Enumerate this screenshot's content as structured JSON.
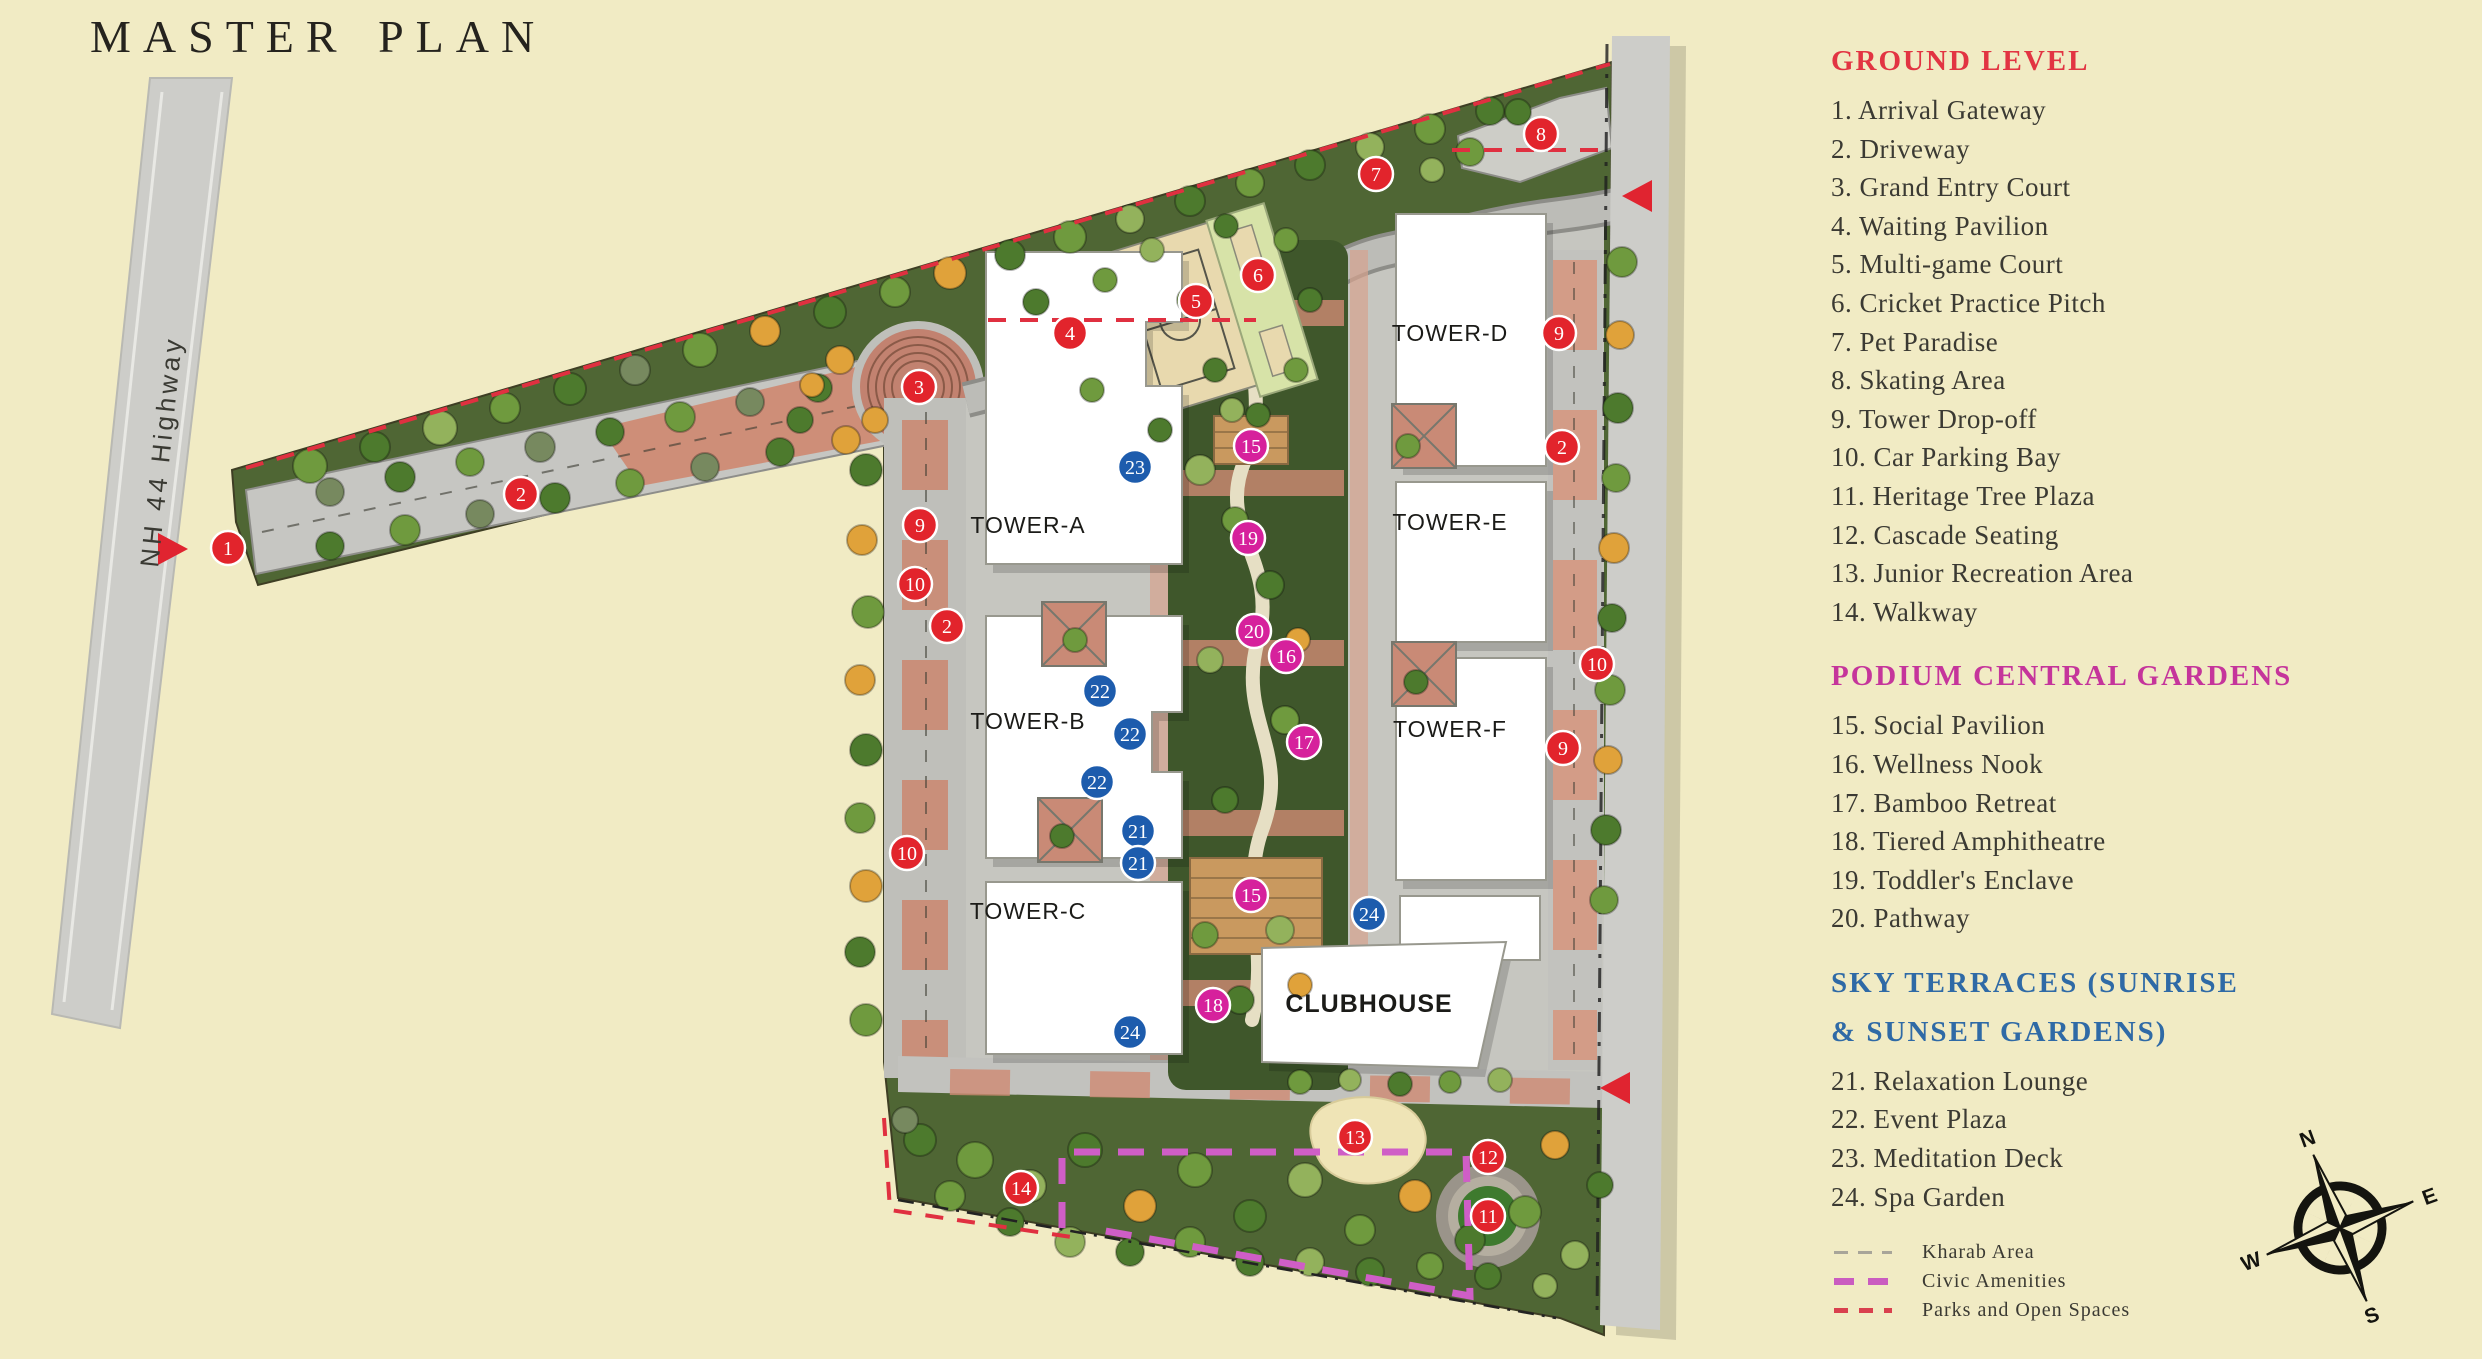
{
  "title": "MASTER PLAN",
  "legend": {
    "sections": [
      {
        "heading_lines": [
          "GROUND LEVEL"
        ],
        "color": "#e23442",
        "items": [
          {
            "n": "1",
            "label": "Arrival Gateway"
          },
          {
            "n": "2",
            "label": "Driveway"
          },
          {
            "n": "3",
            "label": "Grand Entry Court"
          },
          {
            "n": "4",
            "label": "Waiting Pavilion"
          },
          {
            "n": "5",
            "label": "Multi-game Court"
          },
          {
            "n": "6",
            "label": "Cricket Practice Pitch"
          },
          {
            "n": "7",
            "label": "Pet Paradise"
          },
          {
            "n": "8",
            "label": "Skating Area"
          },
          {
            "n": "9",
            "label": "Tower Drop-off"
          },
          {
            "n": "10",
            "label": "Car Parking Bay"
          },
          {
            "n": "11",
            "label": "Heritage Tree Plaza"
          },
          {
            "n": "12",
            "label": "Cascade Seating"
          },
          {
            "n": "13",
            "label": "Junior Recreation Area"
          },
          {
            "n": "14",
            "label": "Walkway"
          }
        ]
      },
      {
        "heading_lines": [
          "PODIUM CENTRAL GARDENS"
        ],
        "color": "#c5359b",
        "items": [
          {
            "n": "15",
            "label": "Social Pavilion"
          },
          {
            "n": "16",
            "label": "Wellness Nook"
          },
          {
            "n": "17",
            "label": "Bamboo Retreat"
          },
          {
            "n": "18",
            "label": "Tiered Amphitheatre"
          },
          {
            "n": "19",
            "label": "Toddler's Enclave"
          },
          {
            "n": "20",
            "label": "Pathway"
          }
        ]
      },
      {
        "heading_lines": [
          "SKY TERRACES (SUNRISE",
          "& SUNSET GARDENS)"
        ],
        "color": "#2f6aa6",
        "items": [
          {
            "n": "21",
            "label": "Relaxation Lounge"
          },
          {
            "n": "22",
            "label": "Event Plaza"
          },
          {
            "n": "23",
            "label": "Meditation Deck"
          },
          {
            "n": "24",
            "label": "Spa Garden"
          }
        ]
      }
    ],
    "line_items": [
      {
        "label": "Kharab Area",
        "color": "#a8a599",
        "thickness": 3,
        "dash": "14px",
        "gap": "10px"
      },
      {
        "label": "Civic Amenities",
        "color": "#ca5cc0",
        "thickness": 7,
        "dash": "20px",
        "gap": "14px"
      },
      {
        "label": "Parks and Open Spaces",
        "color": "#d9404e",
        "thickness": 5,
        "dash": "14px",
        "gap": "11px"
      }
    ]
  },
  "compass": {
    "n": "N",
    "e": "E",
    "s": "S",
    "w": "W"
  },
  "map": {
    "highway_label": "NH 44 Highway",
    "tower_labels": [
      {
        "text": "TOWER-A",
        "x": 1028,
        "y": 533,
        "size": 23,
        "bold": false
      },
      {
        "text": "TOWER-B",
        "x": 1028,
        "y": 729,
        "size": 23,
        "bold": false
      },
      {
        "text": "TOWER-C",
        "x": 1028,
        "y": 919,
        "size": 23,
        "bold": false
      },
      {
        "text": "TOWER-D",
        "x": 1450,
        "y": 341,
        "size": 23,
        "bold": false
      },
      {
        "text": "TOWER-E",
        "x": 1450,
        "y": 530,
        "size": 23,
        "bold": false
      },
      {
        "text": "TOWER-F",
        "x": 1450,
        "y": 737,
        "size": 23,
        "bold": false
      },
      {
        "text": "CLUBHOUSE",
        "x": 1369,
        "y": 1012,
        "size": 25,
        "bold": true
      }
    ],
    "marker_colors": {
      "ground": "#e2242c",
      "podium": "#d6219c",
      "sky": "#1d5cad"
    },
    "markers": [
      {
        "n": "1",
        "g": "ground",
        "x": 228,
        "y": 548
      },
      {
        "n": "2",
        "g": "ground",
        "x": 521,
        "y": 494
      },
      {
        "n": "3",
        "g": "ground",
        "x": 919,
        "y": 387
      },
      {
        "n": "4",
        "g": "ground",
        "x": 1070,
        "y": 333
      },
      {
        "n": "5",
        "g": "ground",
        "x": 1196,
        "y": 301
      },
      {
        "n": "6",
        "g": "ground",
        "x": 1258,
        "y": 275
      },
      {
        "n": "7",
        "g": "ground",
        "x": 1376,
        "y": 174
      },
      {
        "n": "8",
        "g": "ground",
        "x": 1541,
        "y": 134
      },
      {
        "n": "9",
        "g": "ground",
        "x": 1559,
        "y": 333
      },
      {
        "n": "2",
        "g": "ground",
        "x": 1562,
        "y": 447
      },
      {
        "n": "10",
        "g": "ground",
        "x": 1597,
        "y": 664
      },
      {
        "n": "9",
        "g": "ground",
        "x": 1563,
        "y": 748
      },
      {
        "n": "9",
        "g": "ground",
        "x": 920,
        "y": 525
      },
      {
        "n": "10",
        "g": "ground",
        "x": 915,
        "y": 584
      },
      {
        "n": "2",
        "g": "ground",
        "x": 947,
        "y": 626
      },
      {
        "n": "10",
        "g": "ground",
        "x": 907,
        "y": 853
      },
      {
        "n": "13",
        "g": "ground",
        "x": 1355,
        "y": 1137
      },
      {
        "n": "12",
        "g": "ground",
        "x": 1488,
        "y": 1157
      },
      {
        "n": "14",
        "g": "ground",
        "x": 1021,
        "y": 1188
      },
      {
        "n": "11",
        "g": "ground",
        "x": 1488,
        "y": 1216
      },
      {
        "n": "15",
        "g": "podium",
        "x": 1251,
        "y": 446
      },
      {
        "n": "19",
        "g": "podium",
        "x": 1248,
        "y": 538
      },
      {
        "n": "20",
        "g": "podium",
        "x": 1254,
        "y": 631
      },
      {
        "n": "16",
        "g": "podium",
        "x": 1286,
        "y": 656
      },
      {
        "n": "17",
        "g": "podium",
        "x": 1304,
        "y": 742
      },
      {
        "n": "15",
        "g": "podium",
        "x": 1251,
        "y": 895
      },
      {
        "n": "18",
        "g": "podium",
        "x": 1213,
        "y": 1005
      },
      {
        "n": "23",
        "g": "sky",
        "x": 1135,
        "y": 467
      },
      {
        "n": "22",
        "g": "sky",
        "x": 1100,
        "y": 691
      },
      {
        "n": "22",
        "g": "sky",
        "x": 1130,
        "y": 734
      },
      {
        "n": "22",
        "g": "sky",
        "x": 1097,
        "y": 782
      },
      {
        "n": "21",
        "g": "sky",
        "x": 1138,
        "y": 831
      },
      {
        "n": "21",
        "g": "sky",
        "x": 1138,
        "y": 863
      },
      {
        "n": "24",
        "g": "sky",
        "x": 1130,
        "y": 1032
      },
      {
        "n": "24",
        "g": "sky",
        "x": 1369,
        "y": 914
      }
    ],
    "tree_colors": {
      "g1": "#6f9a3e",
      "g2": "#4d7a2d",
      "g3": "#93b25c",
      "g4": "#77895f",
      "o": "#e0a23a",
      "d": "#3f5e2a"
    },
    "trees": [
      [
        310,
        466,
        17,
        "g1"
      ],
      [
        375,
        447,
        15,
        "g2"
      ],
      [
        440,
        428,
        17,
        "g3"
      ],
      [
        505,
        408,
        15,
        "g1"
      ],
      [
        570,
        389,
        16,
        "g2"
      ],
      [
        635,
        370,
        15,
        "g4"
      ],
      [
        700,
        350,
        17,
        "g1"
      ],
      [
        765,
        331,
        15,
        "o"
      ],
      [
        830,
        312,
        16,
        "g2"
      ],
      [
        895,
        292,
        15,
        "g1"
      ],
      [
        950,
        273,
        16,
        "o"
      ],
      [
        1010,
        255,
        15,
        "g2"
      ],
      [
        1070,
        237,
        16,
        "g1"
      ],
      [
        1130,
        219,
        14,
        "g3"
      ],
      [
        1190,
        201,
        15,
        "g2"
      ],
      [
        1250,
        183,
        14,
        "g1"
      ],
      [
        1310,
        165,
        15,
        "g2"
      ],
      [
        1370,
        147,
        14,
        "g3"
      ],
      [
        1430,
        129,
        15,
        "g1"
      ],
      [
        1490,
        111,
        14,
        "g2"
      ],
      [
        330,
        492,
        14,
        "g4"
      ],
      [
        400,
        477,
        15,
        "g2"
      ],
      [
        470,
        462,
        14,
        "g1"
      ],
      [
        540,
        447,
        15,
        "g4"
      ],
      [
        610,
        432,
        14,
        "g2"
      ],
      [
        680,
        417,
        15,
        "g1"
      ],
      [
        750,
        402,
        14,
        "g4"
      ],
      [
        818,
        388,
        14,
        "g2"
      ],
      [
        330,
        546,
        14,
        "g2"
      ],
      [
        405,
        530,
        15,
        "g1"
      ],
      [
        480,
        514,
        14,
        "g4"
      ],
      [
        555,
        498,
        15,
        "g2"
      ],
      [
        630,
        483,
        14,
        "g1"
      ],
      [
        705,
        467,
        14,
        "g4"
      ],
      [
        780,
        452,
        14,
        "g2"
      ],
      [
        846,
        440,
        14,
        "o"
      ],
      [
        875,
        420,
        13,
        "o"
      ],
      [
        866,
        470,
        16,
        "g2"
      ],
      [
        862,
        540,
        15,
        "o"
      ],
      [
        868,
        612,
        16,
        "g1"
      ],
      [
        860,
        680,
        15,
        "o"
      ],
      [
        866,
        750,
        16,
        "g2"
      ],
      [
        860,
        818,
        15,
        "g1"
      ],
      [
        866,
        886,
        16,
        "o"
      ],
      [
        860,
        952,
        15,
        "g2"
      ],
      [
        866,
        1020,
        16,
        "g1"
      ],
      [
        1622,
        262,
        15,
        "g1"
      ],
      [
        1620,
        335,
        14,
        "o"
      ],
      [
        1618,
        408,
        15,
        "g2"
      ],
      [
        1616,
        478,
        14,
        "g1"
      ],
      [
        1614,
        548,
        15,
        "o"
      ],
      [
        1612,
        618,
        14,
        "g2"
      ],
      [
        1610,
        690,
        15,
        "g1"
      ],
      [
        1608,
        760,
        14,
        "o"
      ],
      [
        1606,
        830,
        15,
        "g2"
      ],
      [
        1604,
        900,
        14,
        "g1"
      ],
      [
        920,
        1140,
        16,
        "g2"
      ],
      [
        975,
        1160,
        18,
        "g1"
      ],
      [
        1030,
        1186,
        16,
        "g3"
      ],
      [
        1085,
        1150,
        17,
        "g2"
      ],
      [
        1140,
        1206,
        16,
        "o"
      ],
      [
        1195,
        1170,
        17,
        "g1"
      ],
      [
        1250,
        1216,
        16,
        "g2"
      ],
      [
        1305,
        1180,
        17,
        "g3"
      ],
      [
        1360,
        1230,
        15,
        "g1"
      ],
      [
        1415,
        1196,
        16,
        "o"
      ],
      [
        1470,
        1240,
        15,
        "g2"
      ],
      [
        1525,
        1212,
        16,
        "g1"
      ],
      [
        1575,
        1255,
        14,
        "g3"
      ],
      [
        950,
        1196,
        15,
        "g1"
      ],
      [
        1010,
        1222,
        14,
        "g2"
      ],
      [
        1070,
        1242,
        15,
        "g3"
      ],
      [
        1130,
        1252,
        14,
        "g2"
      ],
      [
        1190,
        1242,
        15,
        "g1"
      ],
      [
        1250,
        1262,
        14,
        "g2"
      ],
      [
        1310,
        1262,
        14,
        "g3"
      ],
      [
        1370,
        1272,
        14,
        "g2"
      ],
      [
        1430,
        1266,
        13,
        "g1"
      ],
      [
        1488,
        1276,
        13,
        "g2"
      ],
      [
        1545,
        1286,
        12,
        "g3"
      ],
      [
        905,
        1120,
        13,
        "g4"
      ],
      [
        1555,
        1145,
        14,
        "o"
      ],
      [
        1600,
        1185,
        13,
        "g2"
      ],
      [
        1200,
        470,
        15,
        "g3"
      ],
      [
        1235,
        520,
        13,
        "g1"
      ],
      [
        1270,
        585,
        14,
        "g2"
      ],
      [
        1210,
        660,
        13,
        "g3"
      ],
      [
        1285,
        720,
        14,
        "g1"
      ],
      [
        1225,
        800,
        13,
        "g2"
      ],
      [
        1280,
        930,
        14,
        "g3"
      ],
      [
        1205,
        935,
        13,
        "g1"
      ],
      [
        1258,
        415,
        12,
        "g2"
      ],
      [
        1298,
        640,
        12,
        "o"
      ],
      [
        1240,
        1000,
        14,
        "g2"
      ],
      [
        1300,
        985,
        12,
        "o"
      ],
      [
        1190,
        300,
        13,
        "g1"
      ],
      [
        1215,
        370,
        12,
        "g2"
      ],
      [
        840,
        360,
        14,
        "o"
      ],
      [
        800,
        420,
        13,
        "g2"
      ],
      [
        812,
        385,
        12,
        "o"
      ],
      [
        1075,
        640,
        12,
        "g1"
      ],
      [
        1062,
        836,
        12,
        "g2"
      ],
      [
        1408,
        446,
        12,
        "g1"
      ],
      [
        1416,
        682,
        12,
        "g2"
      ],
      [
        1470,
        152,
        14,
        "g1"
      ],
      [
        1518,
        112,
        13,
        "g2"
      ],
      [
        1432,
        170,
        12,
        "g3"
      ],
      [
        1300,
        1082,
        12,
        "g1"
      ],
      [
        1350,
        1080,
        11,
        "g3"
      ],
      [
        1400,
        1084,
        12,
        "g2"
      ],
      [
        1450,
        1082,
        11,
        "g1"
      ],
      [
        1500,
        1080,
        12,
        "g3"
      ],
      [
        1036,
        302,
        13,
        "g2"
      ],
      [
        1105,
        280,
        12,
        "g1"
      ],
      [
        1152,
        250,
        12,
        "g3"
      ],
      [
        1226,
        226,
        12,
        "g2"
      ],
      [
        1286,
        240,
        12,
        "g1"
      ],
      [
        1310,
        300,
        12,
        "g2"
      ],
      [
        1296,
        370,
        12,
        "g1"
      ],
      [
        1232,
        410,
        12,
        "g3"
      ],
      [
        1160,
        430,
        12,
        "g2"
      ],
      [
        1092,
        390,
        12,
        "g1"
      ]
    ]
  }
}
